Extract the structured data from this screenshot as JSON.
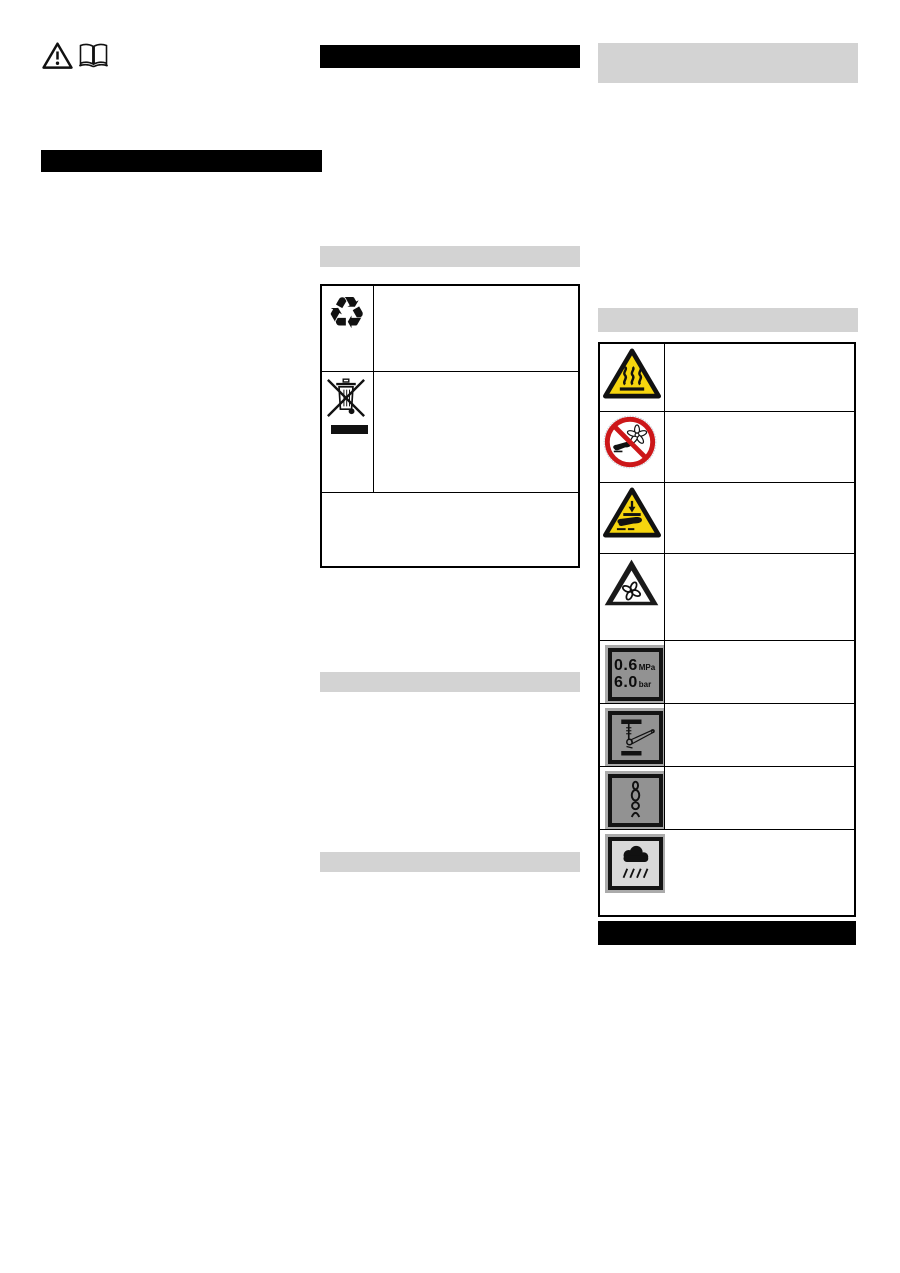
{
  "colors": {
    "page_bg": "#ffffff",
    "black_bar": "#000000",
    "gray_bar": "#d3d3d3",
    "warning_yellow": "#f6d50e",
    "prohibition_red": "#cc1719",
    "plate_dark_gray": "#929292",
    "plate_light_gray": "#d9d9d9",
    "icon_black": "#111111"
  },
  "top_left_icons": [
    {
      "name": "general-warning-triangle-icon"
    },
    {
      "name": "read-manual-book-icon"
    }
  ],
  "left_column": {
    "heading_bar": {
      "style": "black-redacted"
    }
  },
  "middle_column": {
    "heading_bar": {
      "style": "black-redacted"
    },
    "section_bar_1": {
      "style": "gray-redacted"
    },
    "disposal_table": {
      "rows": [
        {
          "icon": "recycling-arrows-icon",
          "glyph": "♻",
          "description": ""
        },
        {
          "icon": "weee-crossed-out-wheeled-bin-icon",
          "description": ""
        },
        {
          "icon": "",
          "description": ""
        }
      ]
    },
    "section_bar_2": {
      "style": "gray-redacted"
    },
    "section_bar_3": {
      "style": "gray-redacted"
    }
  },
  "right_column": {
    "heading_bar": {
      "style": "gray-redacted"
    },
    "subheading_bar": {
      "style": "gray-redacted"
    },
    "symbols_table": {
      "rows": [
        {
          "icon": "hot-surface-warning-icon",
          "description": ""
        },
        {
          "icon": "do-not-reach-into-fan-prohibition-icon",
          "description": ""
        },
        {
          "icon": "hand-crush-warning-icon",
          "description": ""
        },
        {
          "icon": "rotating-fan-warning-icon",
          "description": ""
        },
        {
          "icon": "pressure-plate-icon",
          "description": "",
          "plate_text": {
            "line1_value": "0.6",
            "line1_unit": "MPa",
            "line2_value": "6.0",
            "line2_unit": "bar"
          }
        },
        {
          "icon": "jack-point-plate-icon",
          "description": ""
        },
        {
          "icon": "chain-lashing-plate-icon",
          "description": ""
        },
        {
          "icon": "rain-cloud-plate-icon",
          "description": ""
        }
      ]
    },
    "footer_bar": {
      "style": "black-redacted"
    }
  }
}
